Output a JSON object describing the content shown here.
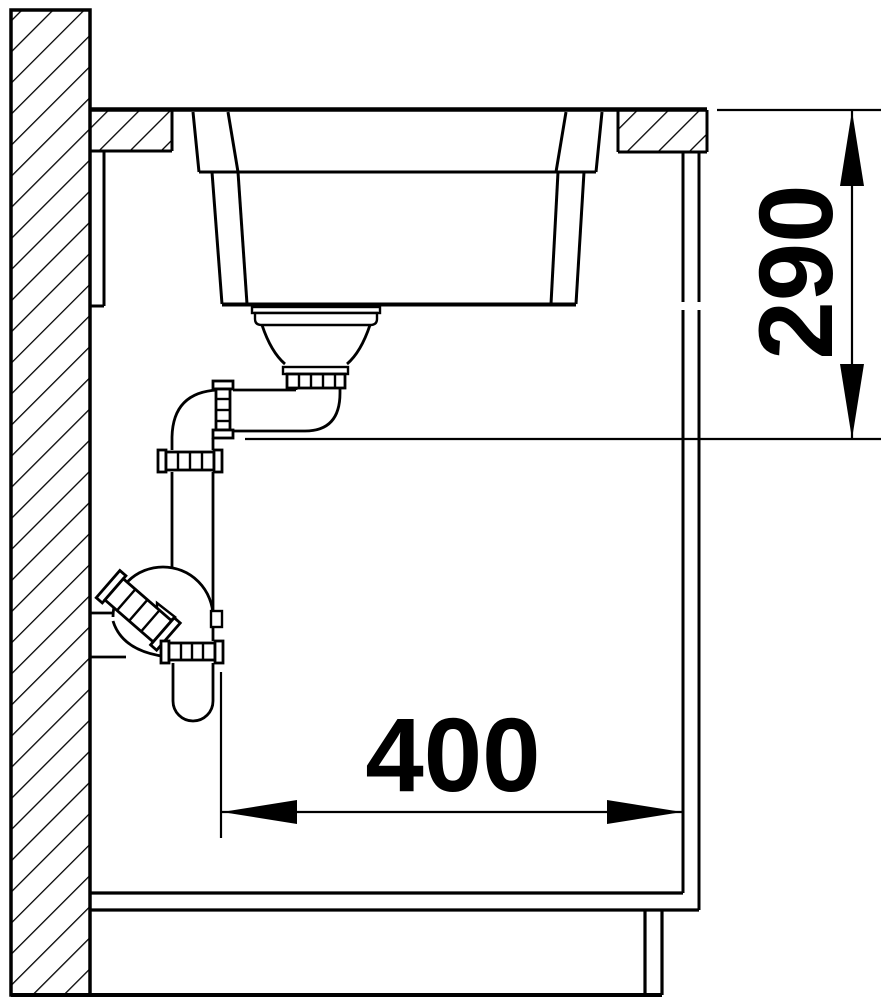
{
  "colors": {
    "ink": "#000000",
    "paper": "#ffffff"
  },
  "dimensions": {
    "vertical": {
      "value": "290"
    },
    "horizontal": {
      "value": "400"
    }
  }
}
